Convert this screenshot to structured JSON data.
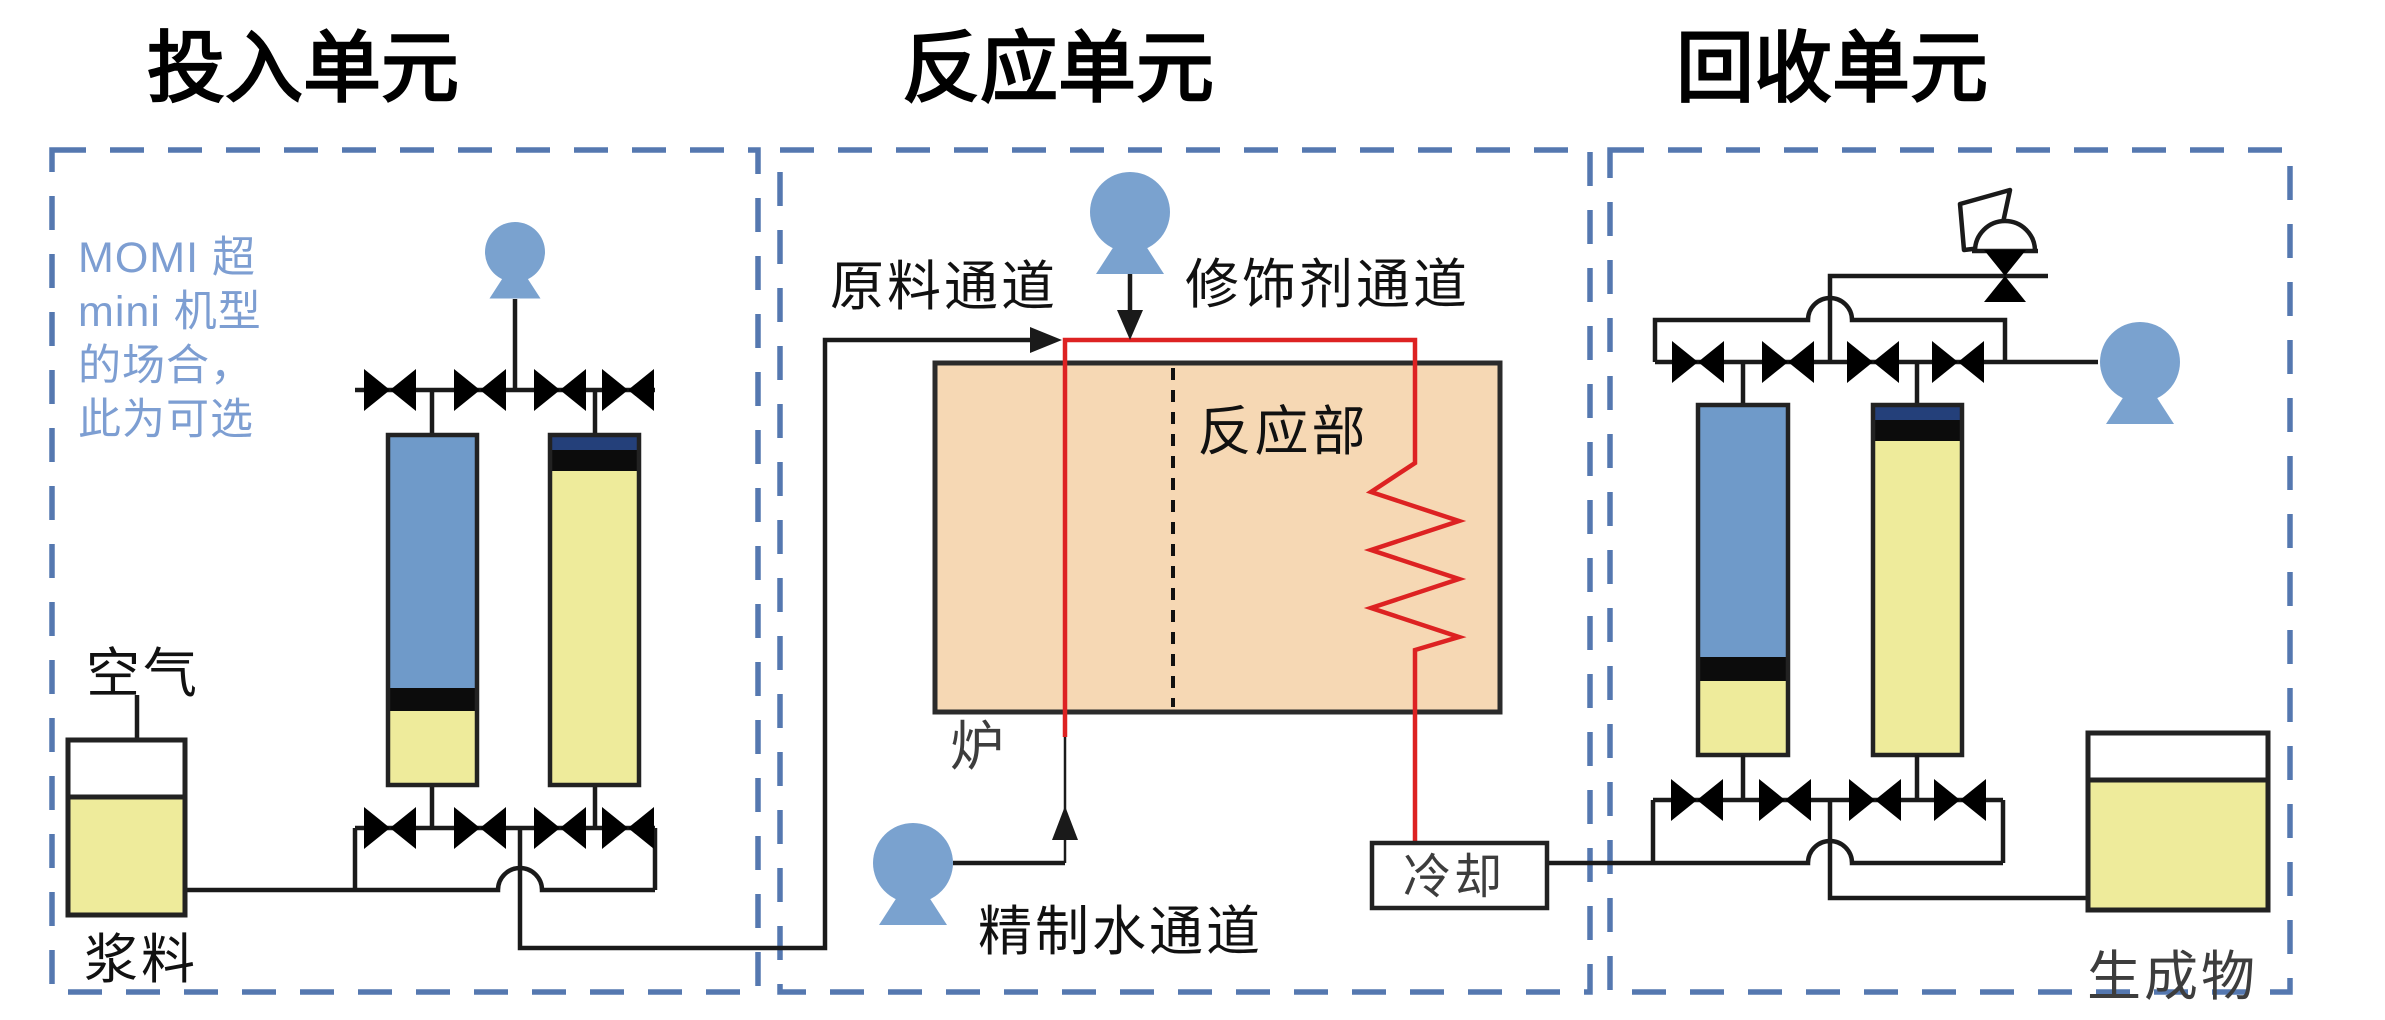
{
  "titles": {
    "input": "投入单元",
    "reaction": "反应单元",
    "recovery": "回收单元"
  },
  "input": {
    "note_lines": [
      "MOMI 超",
      "mini 机型",
      "的场合，",
      "此为可选"
    ],
    "air_label": "空气",
    "slurry_label": "浆料"
  },
  "reaction": {
    "feed_channel_label": "原料通道",
    "modifier_channel_label": "修饰剂通道",
    "reaction_section_label": "反应部",
    "furnace_label": "炉",
    "purified_water_channel_label": "精制水通道",
    "cooling_label": "冷却"
  },
  "recovery": {
    "product_label": "生成物"
  },
  "colors": {
    "pump_blue": "#7aa2cf",
    "column_blue": "#6f9ac9",
    "liquid_yellow": "#eeeb9b",
    "navy_cap": "#24407a",
    "band_black": "#0c0c0c",
    "furnace_fill": "#f6d8b4",
    "line_red": "#dd2222",
    "pipe_black": "#1a1a1a",
    "dashed_border": "#5578b0",
    "note_blue": "#7d9ed2",
    "title_black": "#000000"
  }
}
